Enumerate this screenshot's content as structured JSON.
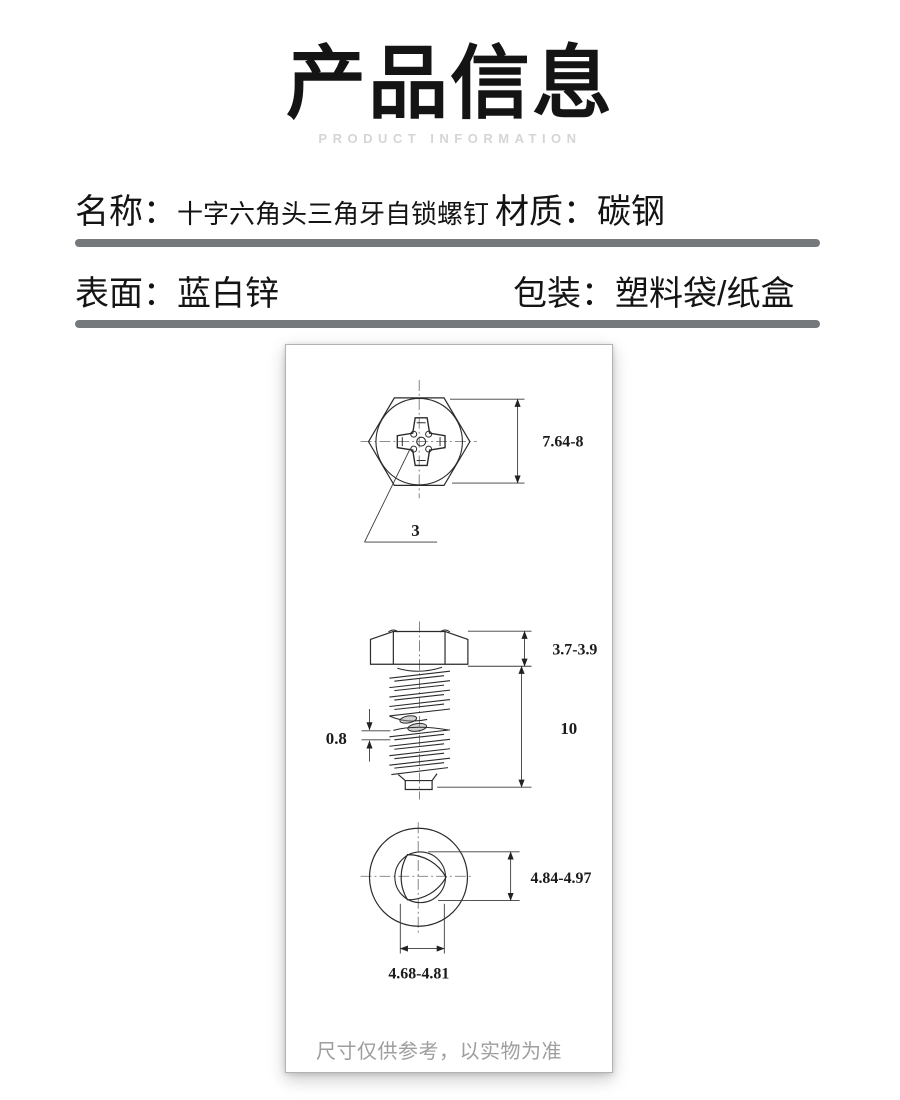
{
  "header": {
    "title": "产品信息",
    "subtitle": "PRODUCT INFORMATION"
  },
  "specs": {
    "row1": {
      "label1": "名称：",
      "value1": "十字六角头三角牙自锁螺钉",
      "label2": "材质：",
      "value2": "碳钢"
    },
    "row2": {
      "label1": "表面：",
      "value1": "蓝白锌",
      "label2": "包装：",
      "value2": "塑料袋/纸盒"
    }
  },
  "drawing": {
    "dimensions": {
      "head_across": "7.64-8",
      "recess_number": "3",
      "head_thickness": "3.7-3.9",
      "shank_length": "10",
      "thread_pitch": "0.8",
      "major_diameter": "4.84-4.97",
      "minor_diameter": "4.68-4.81"
    },
    "note": "尺寸仅供参考，以实物为准"
  },
  "colors": {
    "divider": "#76797c",
    "subtitle_gray": "#d5d5d5",
    "note_gray": "#9e9e9e",
    "drawing_line": "#2a2a2a",
    "title_black": "#141414"
  }
}
